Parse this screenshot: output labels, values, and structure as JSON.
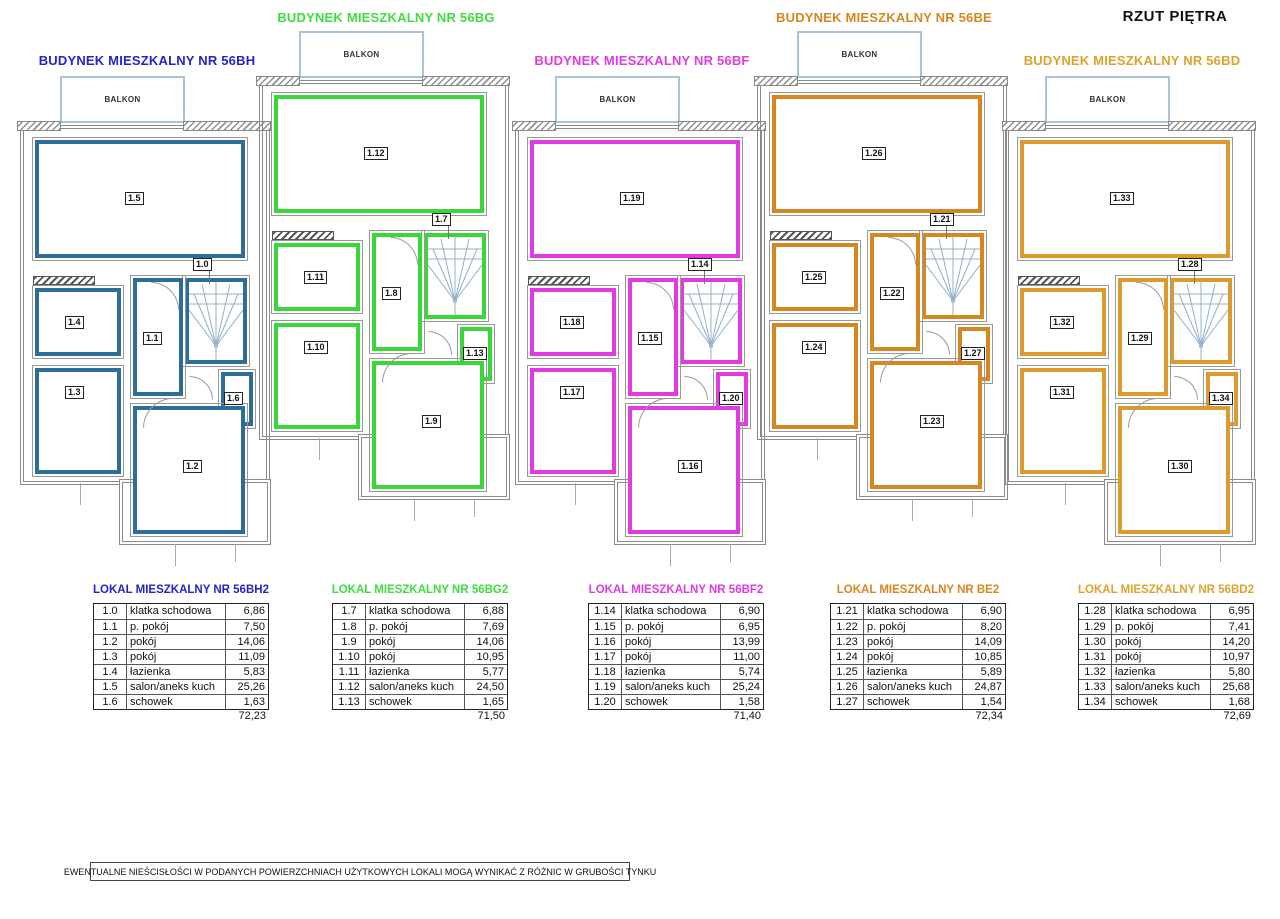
{
  "page": {
    "title": "RZUT PIĘTRA",
    "balcony_label": "BALKON",
    "footer_note": "EWENTUALNE NIEŚCISŁOŚCI W PODANYCH POWIERZCHNIACH UŻYTKOWYCH LOKALI MOGĄ WYNIKAĆ Z RÓŻNIC W GRUBOŚCI TYNKU"
  },
  "buildings": [
    {
      "title": "BUDYNEK MIESZKALNY NR 56BH",
      "table_title": "LOKAL MIESZKALNY NR 56BH2",
      "plan_color": "#2e6d99",
      "title_color": "#2424c8",
      "total": "72,23",
      "rooms": [
        {
          "id": "1.0",
          "name": "klatka schodowa",
          "area": "6,86",
          "role": "staircase"
        },
        {
          "id": "1.1",
          "name": "p. pokój",
          "area": "7,50",
          "role": "hall"
        },
        {
          "id": "1.2",
          "name": "pokój",
          "area": "14,06",
          "role": "room-bottom-right"
        },
        {
          "id": "1.3",
          "name": "pokój",
          "area": "11,09",
          "role": "room-left"
        },
        {
          "id": "1.4",
          "name": "łazienka",
          "area": "5,83",
          "role": "bathroom"
        },
        {
          "id": "1.5",
          "name": "salon/aneks kuch",
          "area": "25,26",
          "role": "living-room"
        },
        {
          "id": "1.6",
          "name": "schowek",
          "area": "1,63",
          "role": "closet"
        }
      ]
    },
    {
      "title": "BUDYNEK MIESZKALNY NR 56BG",
      "table_title": "LOKAL MIESZKALNY NR 56BG2",
      "plan_color": "#38d838",
      "title_color": "#3fdd3f",
      "total": "71,50",
      "rooms": [
        {
          "id": "1.7",
          "name": "klatka schodowa",
          "area": "6,88",
          "role": "staircase"
        },
        {
          "id": "1.8",
          "name": "p. pokój",
          "area": "7,69",
          "role": "hall"
        },
        {
          "id": "1.9",
          "name": "pokój",
          "area": "14,06",
          "role": "room-bottom-right"
        },
        {
          "id": "1.10",
          "name": "pokój",
          "area": "10,95",
          "role": "room-left"
        },
        {
          "id": "1.11",
          "name": "łazienka",
          "area": "5,77",
          "role": "bathroom"
        },
        {
          "id": "1.12",
          "name": "salon/aneks kuch",
          "area": "24,50",
          "role": "living-room"
        },
        {
          "id": "1.13",
          "name": "schowek",
          "area": "1,65",
          "role": "closet"
        }
      ]
    },
    {
      "title": "BUDYNEK MIESZKALNY NR 56BF",
      "table_title": "LOKAL MIESZKALNY NR 56BF2",
      "plan_color": "#e23ae2",
      "title_color": "#e23ae2",
      "total": "71,40",
      "rooms": [
        {
          "id": "1.14",
          "name": "klatka schodowa",
          "area": "6,90",
          "role": "staircase"
        },
        {
          "id": "1.15",
          "name": "p. pokój",
          "area": "6,95",
          "role": "hall"
        },
        {
          "id": "1.16",
          "name": "pokój",
          "area": "13,99",
          "role": "room-bottom-right"
        },
        {
          "id": "1.17",
          "name": "pokój",
          "area": "11,00",
          "role": "room-left"
        },
        {
          "id": "1.18",
          "name": "łazienka",
          "area": "5,74",
          "role": "bathroom"
        },
        {
          "id": "1.19",
          "name": "salon/aneks kuch",
          "area": "25,24",
          "role": "living-room"
        },
        {
          "id": "1.20",
          "name": "schowek",
          "area": "1,58",
          "role": "closet"
        }
      ]
    },
    {
      "title": "BUDYNEK MIESZKALNY NR 56BE",
      "table_title": "LOKAL MIESZKALNY NR BE2",
      "plan_color": "#d8861f",
      "title_color": "#d8861f",
      "total": "72,34",
      "rooms": [
        {
          "id": "1.21",
          "name": "klatka schodowa",
          "area": "6,90",
          "role": "staircase"
        },
        {
          "id": "1.22",
          "name": "p. pokój",
          "area": "8,20",
          "role": "hall"
        },
        {
          "id": "1.23",
          "name": "pokój",
          "area": "14,09",
          "role": "room-bottom-right"
        },
        {
          "id": "1.24",
          "name": "pokój",
          "area": "10,85",
          "role": "room-left"
        },
        {
          "id": "1.25",
          "name": "łazienka",
          "area": "5,89",
          "role": "bathroom"
        },
        {
          "id": "1.26",
          "name": "salon/aneks kuch",
          "area": "24,87",
          "role": "living-room"
        },
        {
          "id": "1.27",
          "name": "schowek",
          "area": "1,54",
          "role": "closet"
        }
      ]
    },
    {
      "title": "BUDYNEK MIESZKALNY NR 56BD",
      "table_title": "LOKAL MIESZKALNY NR 56BD2",
      "plan_color": "#dd9b2e",
      "title_color": "#dda32e",
      "total": "72,69",
      "rooms": [
        {
          "id": "1.28",
          "name": "klatka schodowa",
          "area": "6,95",
          "role": "staircase"
        },
        {
          "id": "1.29",
          "name": "p. pokój",
          "area": "7,41",
          "role": "hall"
        },
        {
          "id": "1.30",
          "name": "pokój",
          "area": "14,20",
          "role": "room-bottom-right"
        },
        {
          "id": "1.31",
          "name": "pokój",
          "area": "10,97",
          "role": "room-left"
        },
        {
          "id": "1.32",
          "name": "łazienka",
          "area": "5,80",
          "role": "bathroom"
        },
        {
          "id": "1.33",
          "name": "salon/aneks kuch",
          "area": "25,68",
          "role": "living-room"
        },
        {
          "id": "1.34",
          "name": "schowek",
          "area": "1,68",
          "role": "closet"
        }
      ]
    }
  ]
}
